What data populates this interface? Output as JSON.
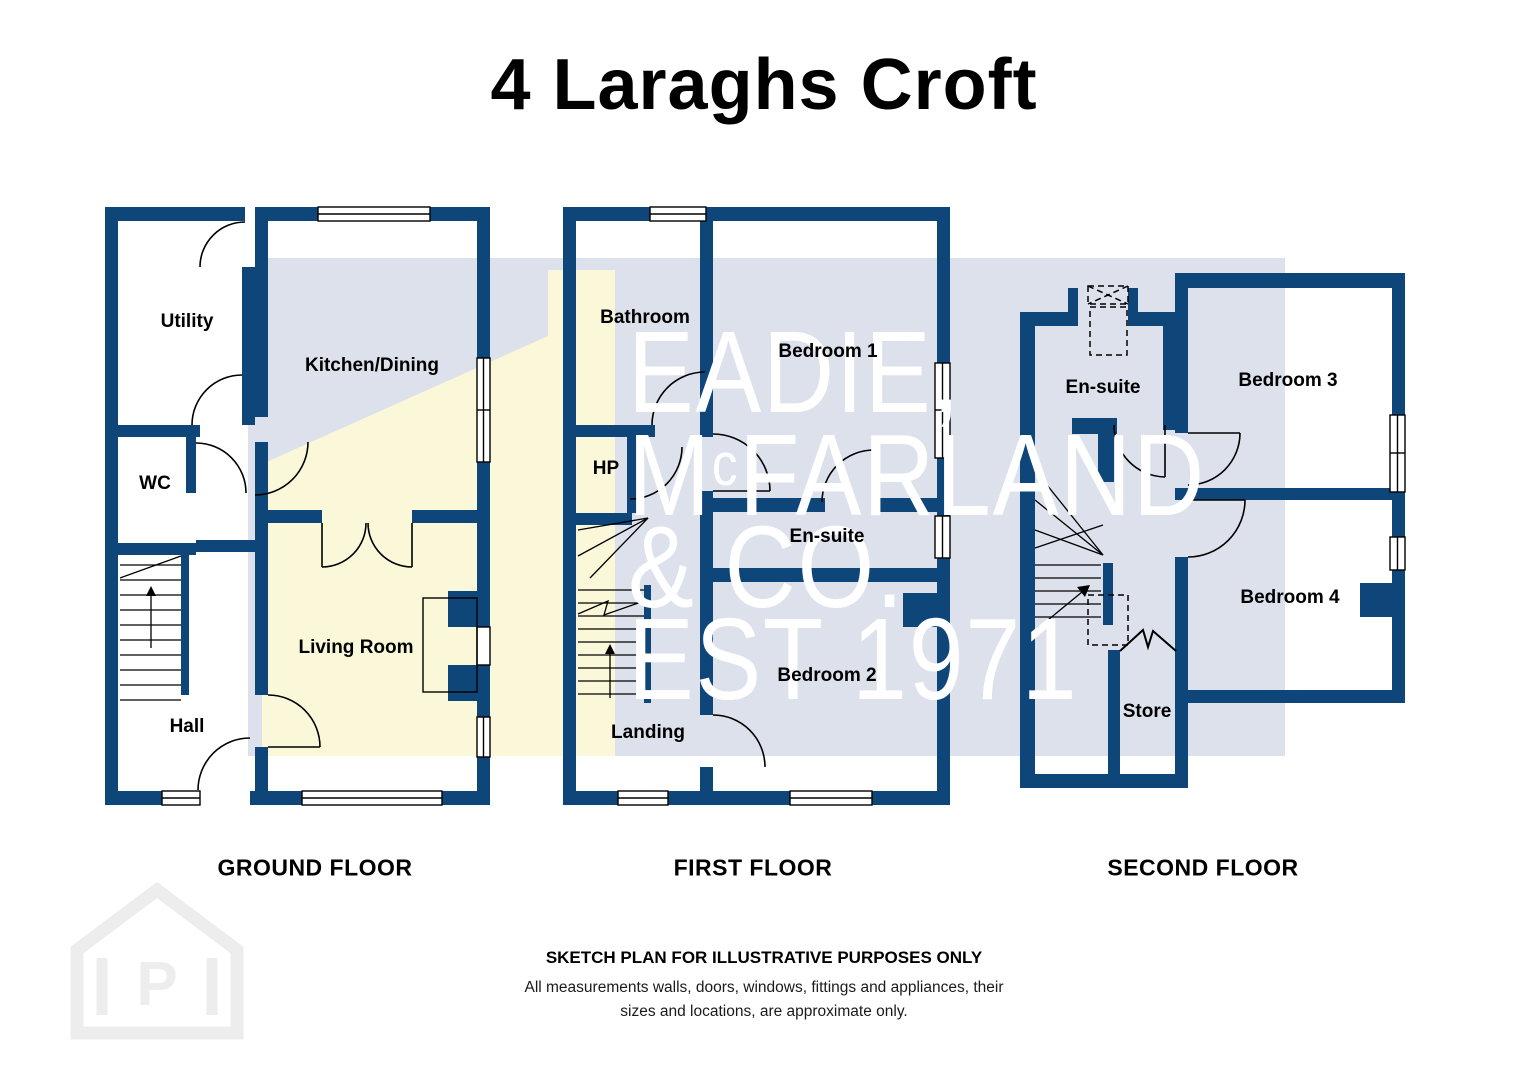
{
  "title": "4 Laraghs Croft",
  "floors": {
    "ground": {
      "label": "GROUND FLOOR",
      "rooms": {
        "utility": "Utility",
        "kitchen_dining": "Kitchen/Dining",
        "wc": "WC",
        "living_room": "Living Room",
        "hall": "Hall"
      }
    },
    "first": {
      "label": "FIRST FLOOR",
      "rooms": {
        "bathroom": "Bathroom",
        "bedroom1": "Bedroom 1",
        "hp": "HP",
        "ensuite": "En-suite",
        "bedroom2": "Bedroom 2",
        "landing": "Landing"
      }
    },
    "second": {
      "label": "SECOND FLOOR",
      "rooms": {
        "ensuite": "En-suite",
        "bedroom3": "Bedroom 3",
        "bedroom4": "Bedroom 4",
        "store": "Store"
      }
    }
  },
  "watermark": {
    "line1": "EADIE,",
    "line2_prefix": "M",
    "line2_sup": "c",
    "line2_rest": "FARLAND",
    "line3": "& CO.",
    "line4": "EST 1971"
  },
  "footer": {
    "heading": "SKETCH PLAN FOR ILLUSTRATIVE PURPOSES ONLY",
    "body1": "All measurements walls, doors, windows, fittings and appliances, their",
    "body2": "sizes and locations, are approximate only."
  },
  "logo": {
    "letter": "P",
    "name": "house-p-logo"
  },
  "colors": {
    "wall": "#0F4679",
    "watermark_blue": "#DCE1EB",
    "watermark_yellow": "#FBF8D9",
    "line": "#000000",
    "logo": "#EDEDED"
  }
}
